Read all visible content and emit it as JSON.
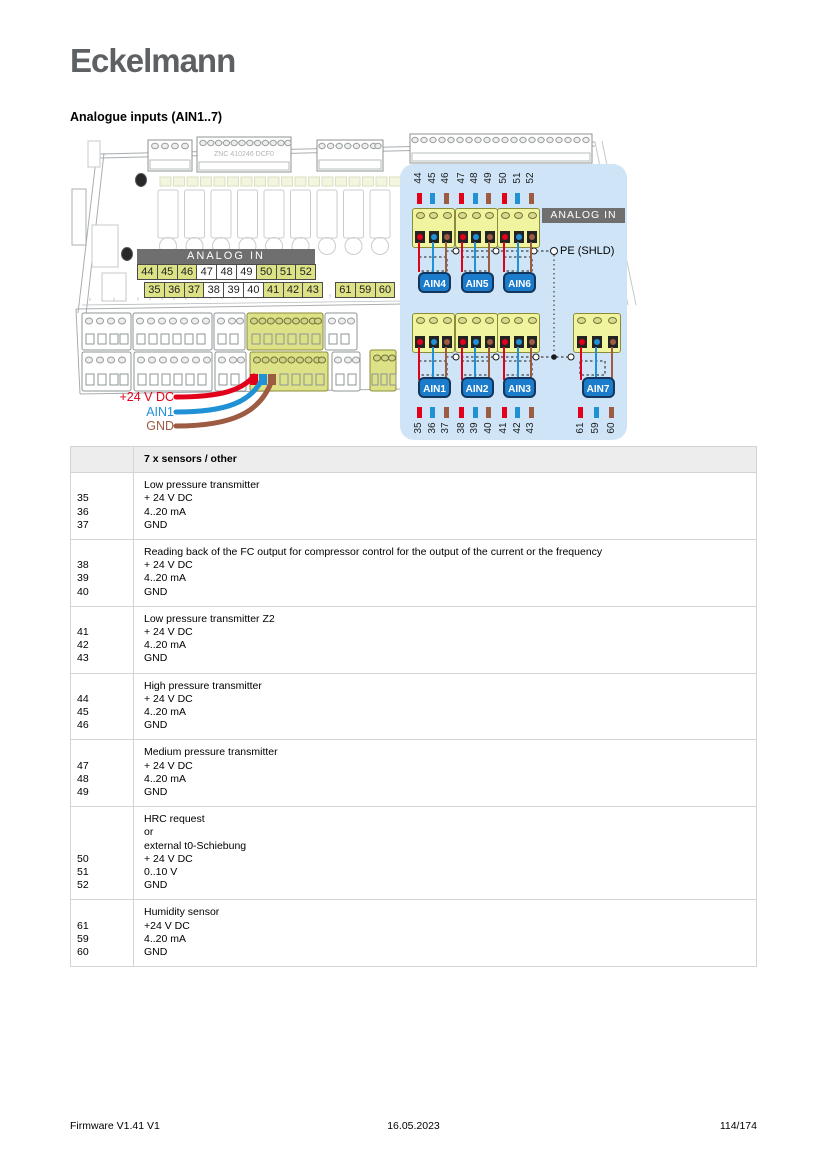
{
  "page": {
    "logo": "Eckelmann",
    "heading": "Analogue inputs (AIN1..7)"
  },
  "footer": {
    "left": "Firmware V1.41 V1",
    "center": "16.05.2023",
    "right": "114/174"
  },
  "colors": {
    "red": "#e2001a",
    "blue": "#2191d6",
    "brown": "#9d5b42",
    "highlight": "#dde287",
    "panel_bg": "#cfe5f7",
    "banner_bg": "#6f6f6f",
    "ain_blue": "#1b7ccc"
  },
  "board": {
    "connector_label": "ZNC 410246 DCF0",
    "analog_in_label": "ANALOG IN",
    "terminal_row_top": [
      {
        "n": "44",
        "hl": true
      },
      {
        "n": "45",
        "hl": true
      },
      {
        "n": "46",
        "hl": true
      },
      {
        "n": "47",
        "hl": false
      },
      {
        "n": "48",
        "hl": false
      },
      {
        "n": "49",
        "hl": false
      },
      {
        "n": "50",
        "hl": true
      },
      {
        "n": "51",
        "hl": true
      },
      {
        "n": "52",
        "hl": true
      }
    ],
    "terminal_row_bottom": [
      {
        "n": "35",
        "hl": true
      },
      {
        "n": "36",
        "hl": true
      },
      {
        "n": "37",
        "hl": true
      },
      {
        "n": "38",
        "hl": false
      },
      {
        "n": "39",
        "hl": false
      },
      {
        "n": "40",
        "hl": false
      },
      {
        "n": "41",
        "hl": true
      },
      {
        "n": "42",
        "hl": true
      },
      {
        "n": "43",
        "hl": true
      }
    ],
    "terminal_row_extra": [
      {
        "n": "61",
        "hl": true
      },
      {
        "n": "59",
        "hl": true
      },
      {
        "n": "60",
        "hl": true
      }
    ],
    "wire_labels": [
      {
        "label": "+24 V DC",
        "color": "red"
      },
      {
        "label": "AIN1",
        "color": "blue"
      },
      {
        "label": "GND",
        "color": "brown"
      }
    ]
  },
  "panel": {
    "analog_in_label": "ANALOG IN",
    "pe_label": "PE (SHLD)",
    "groups_top": [
      {
        "ain": "AIN4",
        "terminals": [
          {
            "n": "44",
            "c": "red"
          },
          {
            "n": "45",
            "c": "blue"
          },
          {
            "n": "46",
            "c": "brown"
          }
        ]
      },
      {
        "ain": "AIN5",
        "terminals": [
          {
            "n": "47",
            "c": "red"
          },
          {
            "n": "48",
            "c": "blue"
          },
          {
            "n": "49",
            "c": "brown"
          }
        ]
      },
      {
        "ain": "AIN6",
        "terminals": [
          {
            "n": "50",
            "c": "red"
          },
          {
            "n": "51",
            "c": "blue"
          },
          {
            "n": "52",
            "c": "brown"
          }
        ]
      }
    ],
    "groups_bottom": [
      {
        "ain": "AIN1",
        "terminals": [
          {
            "n": "35",
            "c": "red"
          },
          {
            "n": "36",
            "c": "blue"
          },
          {
            "n": "37",
            "c": "brown"
          }
        ]
      },
      {
        "ain": "AIN2",
        "terminals": [
          {
            "n": "38",
            "c": "red"
          },
          {
            "n": "39",
            "c": "blue"
          },
          {
            "n": "40",
            "c": "brown"
          }
        ]
      },
      {
        "ain": "AIN3",
        "terminals": [
          {
            "n": "41",
            "c": "red"
          },
          {
            "n": "42",
            "c": "blue"
          },
          {
            "n": "43",
            "c": "brown"
          }
        ]
      }
    ],
    "group_ain7": {
      "ain": "AIN7",
      "terminals": [
        {
          "n": "61",
          "c": "red"
        },
        {
          "n": "59",
          "c": "blue"
        },
        {
          "n": "60",
          "c": "brown"
        }
      ]
    }
  },
  "table": {
    "header": "7 x sensors / other",
    "rows": [
      {
        "terminals": [
          "35",
          "36",
          "37"
        ],
        "lines": [
          "Low pressure transmitter",
          "+ 24 V DC",
          "4..20 mA",
          "GND"
        ]
      },
      {
        "terminals": [
          "38",
          "39",
          "40"
        ],
        "lines": [
          "Reading back of the FC output for compressor control for the output of the current or the frequency",
          "+ 24 V DC",
          "4..20 mA",
          "GND"
        ]
      },
      {
        "terminals": [
          "41",
          "42",
          "43"
        ],
        "lines": [
          "Low pressure transmitter Z2",
          "+ 24 V DC",
          "4..20 mA",
          "GND"
        ]
      },
      {
        "terminals": [
          "44",
          "45",
          "46"
        ],
        "lines": [
          "High pressure transmitter",
          "+ 24 V DC",
          "4..20 mA",
          "GND"
        ]
      },
      {
        "terminals": [
          "47",
          "48",
          "49"
        ],
        "lines": [
          "Medium pressure transmitter",
          "+ 24 V DC",
          "4..20 mA",
          "GND"
        ]
      },
      {
        "terminals": [
          "50",
          "51",
          "52"
        ],
        "lines": [
          "HRC request",
          "or",
          "external t0-Schiebung",
          "+ 24 V DC",
          "0..10 V",
          "GND"
        ]
      },
      {
        "terminals": [
          "61",
          "59",
          "60"
        ],
        "lines": [
          "Humidity sensor",
          "+24 V DC",
          "4..20 mA",
          "GND"
        ]
      }
    ]
  }
}
